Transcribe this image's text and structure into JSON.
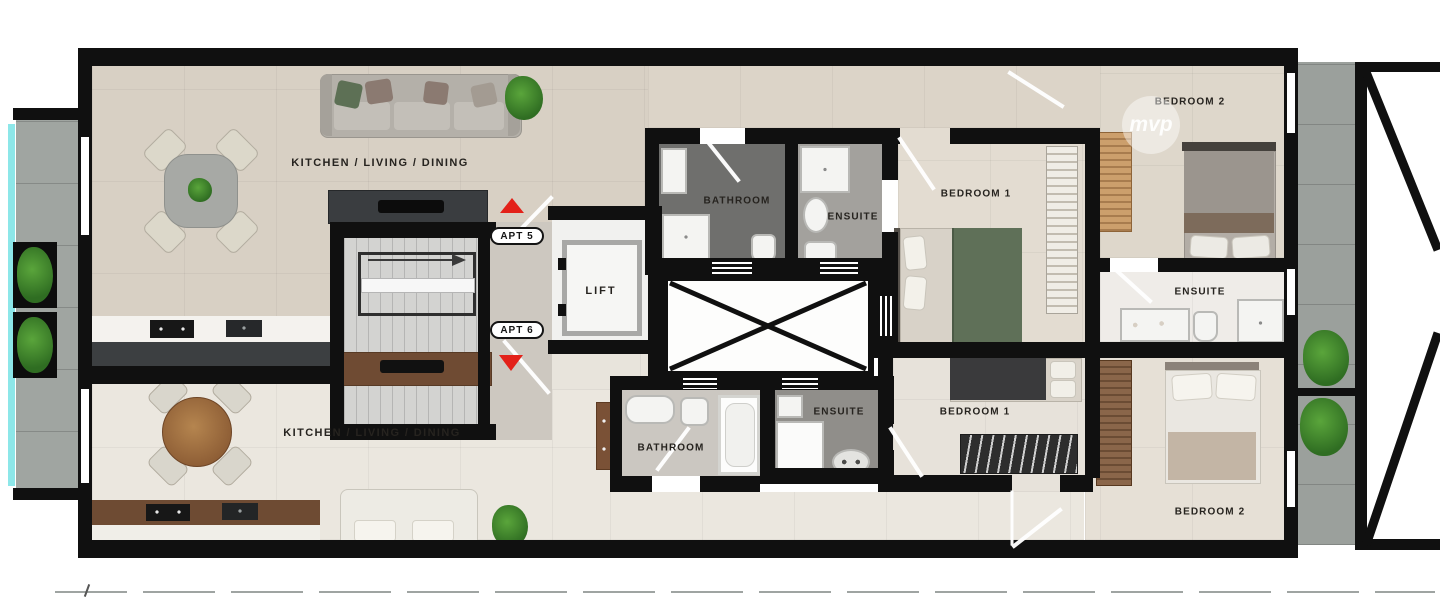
{
  "floorplan": {
    "watermark": "mvp",
    "common": {
      "lift_label": "LIFT",
      "apt5_badge": "APT 5",
      "apt6_badge": "APT 6"
    },
    "apartment5": {
      "living_label": "KITCHEN / LIVING / DINING",
      "bathroom_label": "BATHROOM",
      "ensuite_label": "ENSUITE",
      "bedroom1_label": "BEDROOM 1",
      "bedroom2_label": "BEDROOM 2",
      "bedroom2_ensuite_label": "ENSUITE"
    },
    "apartment6": {
      "living_label": "KITCHEN / LIVING / DINING",
      "bathroom_label": "BATHROOM",
      "ensuite_label": "ENSUITE",
      "bedroom1_label": "BEDROOM 1",
      "bedroom2_label": "BEDROOM 2"
    },
    "icons": {
      "apt5_marker": "red-triangle-up",
      "apt6_marker": "red-triangle-down"
    },
    "colors": {
      "wall": "#101010",
      "marker_red": "#e32119",
      "glass_teal": "#8de7e9",
      "floor_warm": "#d8d0c4",
      "floor_light": "#ebe7df",
      "bathroom_dark": "#6f6f6d",
      "counter_wood": "#6e4b33",
      "plant_green": "#3e7a2c"
    }
  }
}
